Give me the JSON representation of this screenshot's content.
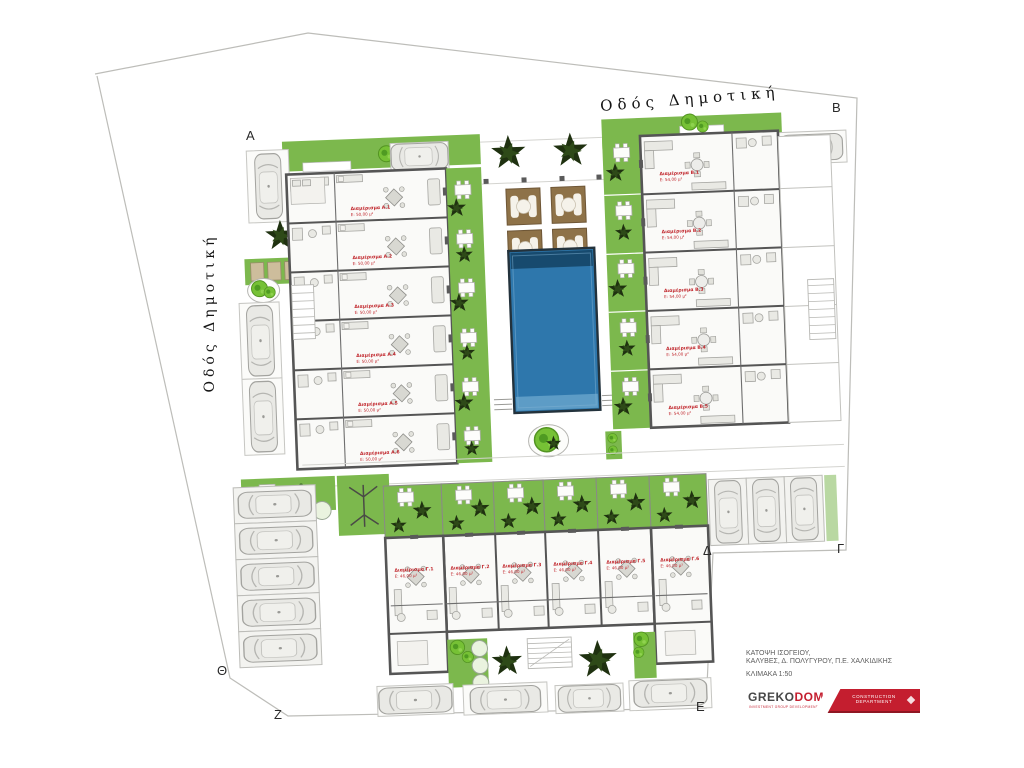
{
  "streets": {
    "top_label": "Οδός Δημοτική",
    "left_label": "Οδός Δημοτική"
  },
  "markers": [
    {
      "label": "Α"
    },
    {
      "label": "Β"
    },
    {
      "label": "Γ"
    },
    {
      "label": "Δ"
    },
    {
      "label": "Ε"
    },
    {
      "label": "Ζ"
    },
    {
      "label": "Θ"
    }
  ],
  "units": {
    "left": [
      {
        "name": "Διαμέρισμα Α.1",
        "area": "Ε: 50,00 μ²"
      },
      {
        "name": "Διαμέρισμα Α.2",
        "area": "Ε: 50,00 μ²"
      },
      {
        "name": "Διαμέρισμα Α.3",
        "area": "Ε: 50,00 μ²"
      },
      {
        "name": "Διαμέρισμα Α.4",
        "area": "Ε: 50,00 μ²"
      },
      {
        "name": "Διαμέρισμα Α.5",
        "area": "Ε: 50,00 μ²"
      },
      {
        "name": "Διαμέρισμα Α.6",
        "area": "Ε: 50,00 μ²"
      }
    ],
    "right": [
      {
        "name": "Διαμέρισμα Β.1",
        "area": "Ε: 54,00 μ²"
      },
      {
        "name": "Διαμέρισμα Β.2",
        "area": "Ε: 54,00 μ²"
      },
      {
        "name": "Διαμέρισμα Β.3",
        "area": "Ε: 54,00 μ²"
      },
      {
        "name": "Διαμέρισμα Β.4",
        "area": "Ε: 54,00 μ²"
      },
      {
        "name": "Διαμέρισμα Β.5",
        "area": "Ε: 54,00 μ²"
      }
    ],
    "bottom": [
      {
        "name": "Διαμέρισμα Γ.1",
        "area": "Ε: 46,00 μ²"
      },
      {
        "name": "Διαμέρισμα Γ.2",
        "area": "Ε: 46,00 μ²"
      },
      {
        "name": "Διαμέρισμα Γ.3",
        "area": "Ε: 46,00 μ²"
      },
      {
        "name": "Διαμέρισμα Γ.4",
        "area": "Ε: 46,00 μ²"
      },
      {
        "name": "Διαμέρισμα Γ.5",
        "area": "Ε: 46,00 μ²"
      },
      {
        "name": "Διαμέρισμα Γ.6",
        "area": "Ε: 46,00 μ²"
      }
    ]
  },
  "title_block": {
    "line1": "ΚΑΤΟΨΗ ΙΣΟΓΕΙΟΥ,",
    "line2": "ΚΑΛΥΒΕΣ, Δ. ΠΟΛΥΓΥΡΟΥ, Π.Ε. ΧΑΛΚΙΔΙΚΗΣ",
    "scale": "ΚΛΙΜΑΚΑ 1:50"
  },
  "logo": {
    "brand_left": "GREKO",
    "brand_right": "DOM",
    "tagline": "INVESTMENT GROUP DEVELOPMENT",
    "banner_line1": "CONSTRUCTION",
    "banner_line2": "DEPARTMENT"
  },
  "colors": {
    "garden_green": "#7cb84d",
    "pool_blue": "#2e77ac",
    "pool_dark": "#174a6e",
    "pergola_brown": "#8e7248",
    "label_red": "#c1272d",
    "wall_gray": "#555555",
    "logo_red": "#c41e2f"
  }
}
